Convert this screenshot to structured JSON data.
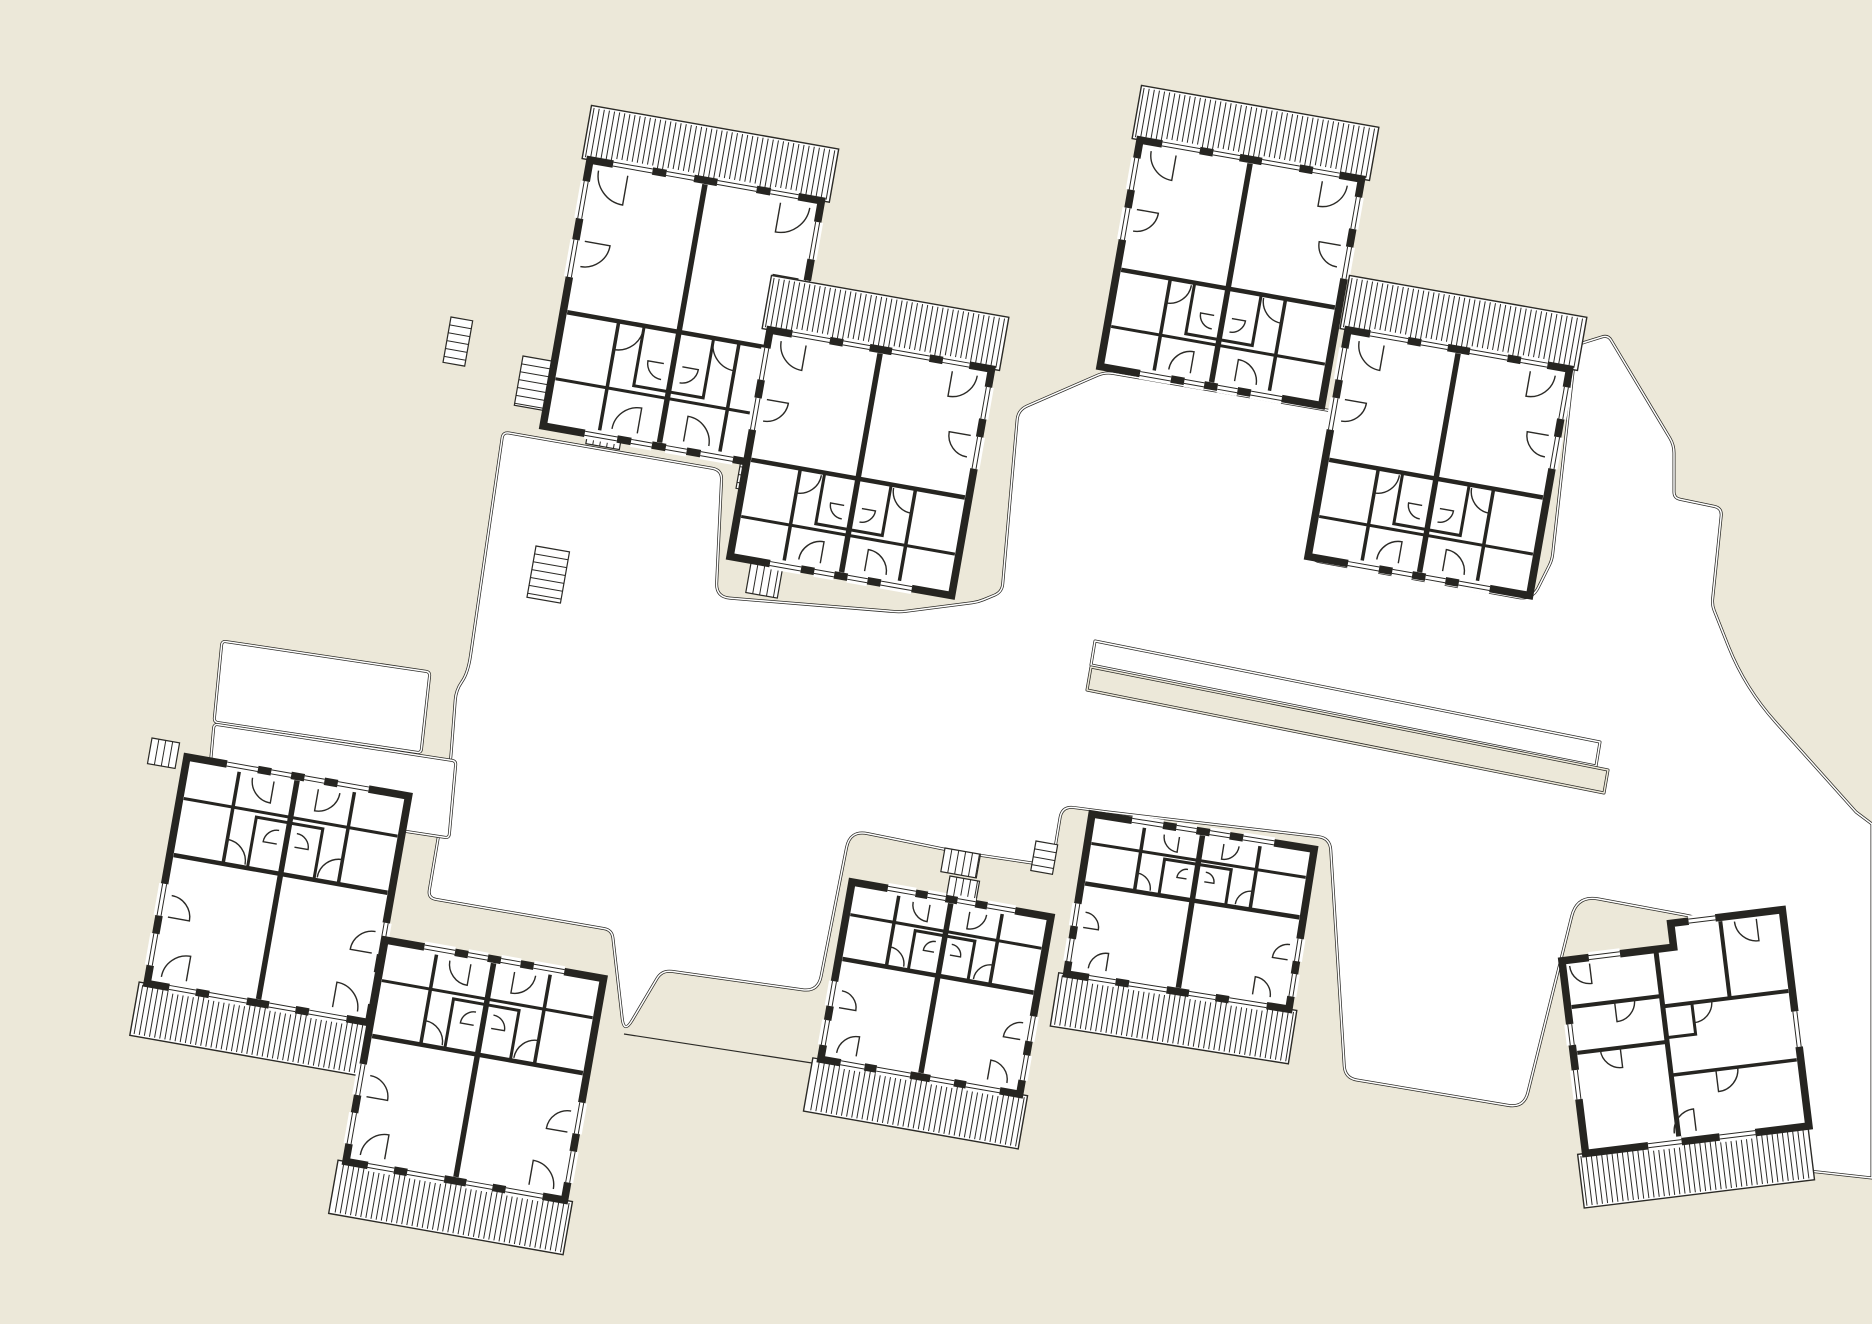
{
  "drawing": {
    "kind": "architectural-site-plan",
    "units_visible": 9,
    "palette": {
      "background": "#ece8d9",
      "paper": "#ffffff",
      "ink": "#2b2a26",
      "wall": "#262521"
    },
    "site": {
      "width": 1872,
      "height": 1324
    }
  },
  "plaza": {
    "points": [
      [
        468,
        673,
        18
      ],
      [
        503,
        432,
        6
      ],
      [
        722,
        470,
        10
      ],
      [
        716,
        597,
        14
      ],
      [
        900,
        612,
        6
      ],
      [
        978,
        602,
        6
      ],
      [
        1002,
        592,
        8
      ],
      [
        1018,
        410,
        10
      ],
      [
        1105,
        372,
        8
      ],
      [
        1338,
        412,
        8
      ],
      [
        1310,
        560,
        10
      ],
      [
        1532,
        600,
        14
      ],
      [
        1552,
        560,
        6
      ],
      [
        1576,
        345,
        8
      ],
      [
        1608,
        335,
        6
      ],
      [
        1674,
        445,
        8
      ],
      [
        1674,
        498,
        6
      ],
      [
        1722,
        508,
        8
      ],
      [
        1712,
        605,
        6
      ],
      [
        1745,
        688,
        46
      ],
      [
        1856,
        812,
        0
      ],
      [
        1872,
        824,
        0
      ],
      [
        1872,
        1178,
        0
      ],
      [
        1800,
        1170,
        10
      ],
      [
        1788,
        942,
        10
      ],
      [
        1690,
        916,
        6
      ],
      [
        1577,
        895,
        22
      ],
      [
        1524,
        1108,
        16
      ],
      [
        1345,
        1078,
        12
      ],
      [
        1330,
        838,
        12
      ],
      [
        1108,
        812,
        14
      ],
      [
        1062,
        806,
        12
      ],
      [
        1052,
        866,
        10
      ],
      [
        958,
        852,
        8
      ],
      [
        850,
        830,
        18
      ],
      [
        818,
        992,
        16
      ],
      [
        662,
        970,
        10
      ],
      [
        624,
        1034,
        16
      ],
      [
        612,
        930,
        8
      ],
      [
        428,
        898,
        8
      ],
      [
        450,
        768,
        18
      ],
      [
        456,
        690,
        10
      ]
    ]
  },
  "walk_fingers": [
    {
      "points": [
        [
          222,
          641,
          4
        ],
        [
          430,
          672,
          4
        ],
        [
          421,
          753,
          4
        ],
        [
          214,
          722,
          4
        ]
      ]
    },
    {
      "points": [
        [
          214,
          724,
          4
        ],
        [
          456,
          761,
          4
        ],
        [
          449,
          838,
          4
        ],
        [
          207,
          801,
          4
        ]
      ]
    }
  ],
  "terrace_strip": {
    "white_band": [
      [
        1095,
        641,
        0
      ],
      [
        1600,
        742,
        0
      ],
      [
        1596,
        766,
        0
      ],
      [
        1091,
        665,
        0
      ]
    ],
    "beige_band": [
      [
        1091,
        667,
        0
      ],
      [
        1608,
        770,
        0
      ],
      [
        1604,
        793,
        0
      ],
      [
        1087,
        690,
        0
      ]
    ]
  },
  "ground_lines": [
    [
      [
        624,
        1034
      ],
      [
        812,
        1063
      ]
    ],
    [
      [
        1120,
        372
      ],
      [
        1292,
        402
      ]
    ]
  ],
  "stairs": [
    [
      536,
      546,
      34,
      52,
      10
    ],
    [
      744,
      443,
      32,
      46,
      10
    ],
    [
      451,
      317,
      22,
      46,
      10
    ],
    [
      945,
      848,
      36,
      24,
      10
    ],
    [
      950,
      876,
      30,
      20,
      10
    ],
    [
      1036,
      841,
      22,
      30,
      10
    ],
    [
      751,
      563,
      32,
      30,
      10
    ],
    [
      523,
      356,
      34,
      50,
      10
    ],
    [
      590,
      420,
      34,
      24,
      10
    ],
    [
      152,
      738,
      28,
      26,
      10
    ]
  ],
  "buildings": [
    {
      "id": "unit-1",
      "type": "duplex",
      "x": 590,
      "y": 160,
      "w": 235,
      "h": 270,
      "rot": 10,
      "flip": false
    },
    {
      "id": "unit-2",
      "type": "duplex",
      "x": 770,
      "y": 330,
      "w": 225,
      "h": 230,
      "rot": 10,
      "flip": false
    },
    {
      "id": "unit-3",
      "type": "duplex",
      "x": 1140,
      "y": 140,
      "w": 225,
      "h": 230,
      "rot": 10,
      "flip": false
    },
    {
      "id": "unit-4",
      "type": "duplex",
      "x": 1348,
      "y": 330,
      "w": 225,
      "h": 230,
      "rot": 10,
      "flip": false
    },
    {
      "id": "unit-5",
      "type": "duplex",
      "x": 187,
      "y": 757,
      "w": 225,
      "h": 230,
      "rot": 10,
      "flip": true
    },
    {
      "id": "unit-6",
      "type": "duplex",
      "x": 385,
      "y": 940,
      "w": 222,
      "h": 225,
      "rot": 10,
      "flip": true
    },
    {
      "id": "unit-7",
      "type": "duplex",
      "x": 852,
      "y": 882,
      "w": 202,
      "h": 180,
      "rot": 10,
      "flip": true
    },
    {
      "id": "unit-8",
      "type": "duplex",
      "x": 1092,
      "y": 814,
      "w": 225,
      "h": 162,
      "rot": 9,
      "flip": true
    },
    {
      "id": "unit-9",
      "type": "corner",
      "x": 1560,
      "y": 945,
      "w": 225,
      "h": 210,
      "rot": -7,
      "flip": false
    }
  ],
  "deck": {
    "depth": 54,
    "overhang": 8,
    "stripe_step": 5.2
  },
  "duplex_layout": {
    "band1": 0.57,
    "band2": 0.82,
    "gaps_top": [
      [
        0.1,
        0.27
      ],
      [
        0.33,
        0.45
      ],
      [
        0.55,
        0.72
      ],
      [
        0.78,
        0.9
      ]
    ],
    "gaps_bottom": [
      [
        0.18,
        0.32
      ],
      [
        0.38,
        0.47
      ],
      [
        0.53,
        0.62
      ],
      [
        0.68,
        0.82
      ]
    ],
    "gaps_side": [
      [
        0.08,
        0.22
      ],
      [
        0.3,
        0.44
      ]
    ]
  }
}
